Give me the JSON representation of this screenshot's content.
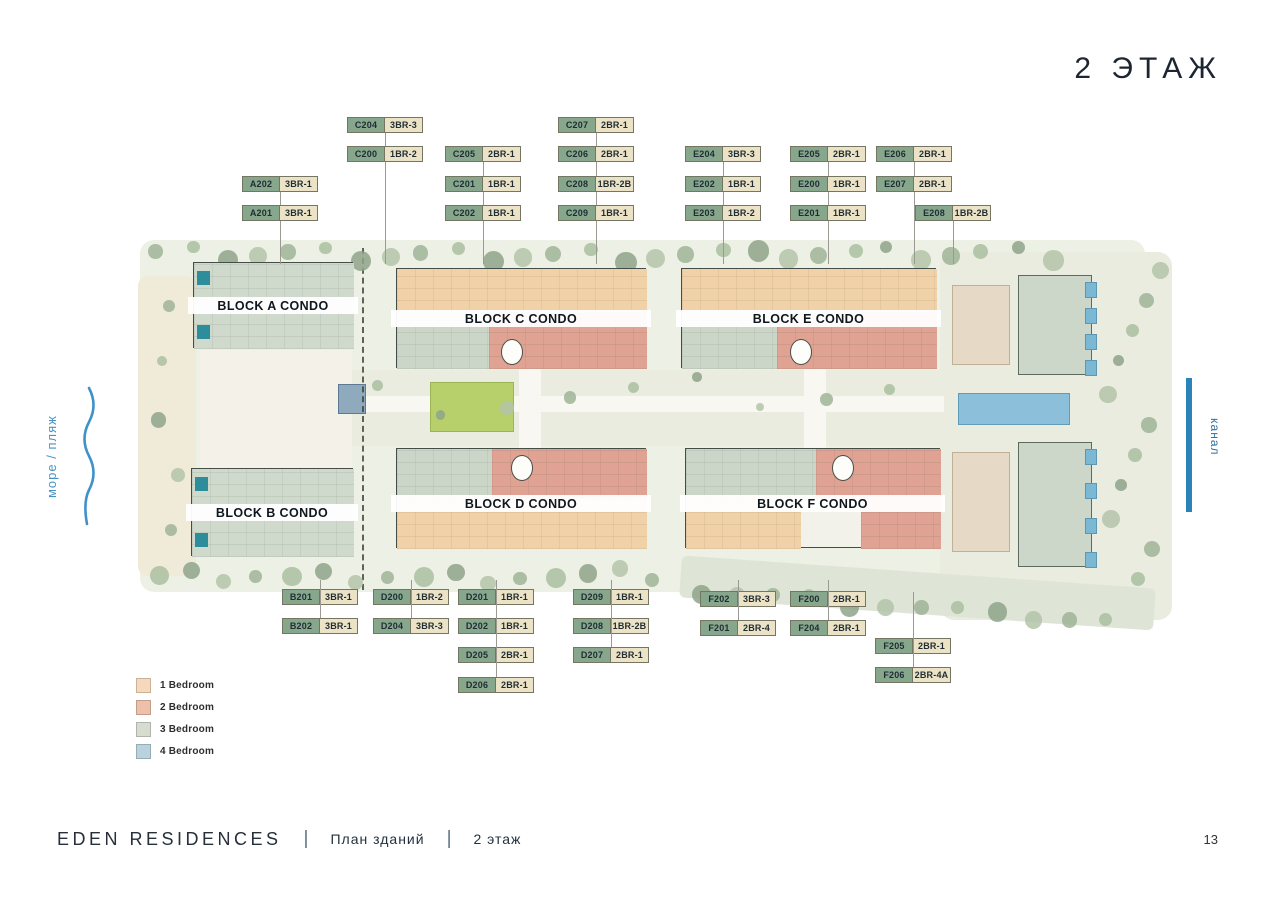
{
  "title": "2 ЭТАЖ",
  "page_number": "13",
  "side_labels": {
    "left": "море / пляж",
    "right": "канал"
  },
  "footer": {
    "brand": "EDEN RESIDENCES",
    "sep1": "|",
    "section": "План зданий",
    "sep2": "|",
    "floor": "2 этаж"
  },
  "legend": {
    "items": [
      {
        "label": "1 Bedroom",
        "color": "#f6d9ba"
      },
      {
        "label": "2 Bedroom",
        "color": "#eec0aa"
      },
      {
        "label": "3 Bedroom",
        "color": "#d6ddd0"
      },
      {
        "label": "4 Bedroom",
        "color": "#b9d2dd"
      }
    ]
  },
  "blocks": [
    {
      "id": "A",
      "label": "BLOCK A CONDO"
    },
    {
      "id": "B",
      "label": "BLOCK B CONDO"
    },
    {
      "id": "C",
      "label": "BLOCK C CONDO"
    },
    {
      "id": "D",
      "label": "BLOCK D CONDO"
    },
    {
      "id": "E",
      "label": "BLOCK E CONDO"
    },
    {
      "id": "F",
      "label": "BLOCK F CONDO"
    }
  ],
  "units": [
    {
      "unit": "A202",
      "type": "3BR-1",
      "x": 242,
      "y": 176,
      "dir": "down"
    },
    {
      "unit": "A201",
      "type": "3BR-1",
      "x": 242,
      "y": 205,
      "dir": "down"
    },
    {
      "unit": "C204",
      "type": "3BR-3",
      "x": 347,
      "y": 117,
      "dir": "down"
    },
    {
      "unit": "C200",
      "type": "1BR-2",
      "x": 347,
      "y": 146,
      "dir": "down"
    },
    {
      "unit": "C205",
      "type": "2BR-1",
      "x": 445,
      "y": 146,
      "dir": "down"
    },
    {
      "unit": "C201",
      "type": "1BR-1",
      "x": 445,
      "y": 176,
      "dir": "down"
    },
    {
      "unit": "C202",
      "type": "1BR-1",
      "x": 445,
      "y": 205,
      "dir": "down"
    },
    {
      "unit": "C207",
      "type": "2BR-1",
      "x": 558,
      "y": 117,
      "dir": "down"
    },
    {
      "unit": "C206",
      "type": "2BR-1",
      "x": 558,
      "y": 146,
      "dir": "down"
    },
    {
      "unit": "C208",
      "type": "1BR-2B",
      "x": 558,
      "y": 176,
      "dir": "down"
    },
    {
      "unit": "C209",
      "type": "1BR-1",
      "x": 558,
      "y": 205,
      "dir": "down"
    },
    {
      "unit": "E204",
      "type": "3BR-3",
      "x": 685,
      "y": 146,
      "dir": "down"
    },
    {
      "unit": "E202",
      "type": "1BR-1",
      "x": 685,
      "y": 176,
      "dir": "down"
    },
    {
      "unit": "E203",
      "type": "1BR-2",
      "x": 685,
      "y": 205,
      "dir": "down"
    },
    {
      "unit": "E205",
      "type": "2BR-1",
      "x": 790,
      "y": 146,
      "dir": "down"
    },
    {
      "unit": "E200",
      "type": "1BR-1",
      "x": 790,
      "y": 176,
      "dir": "down"
    },
    {
      "unit": "E201",
      "type": "1BR-1",
      "x": 790,
      "y": 205,
      "dir": "down"
    },
    {
      "unit": "E206",
      "type": "2BR-1",
      "x": 876,
      "y": 146,
      "dir": "down"
    },
    {
      "unit": "E207",
      "type": "2BR-1",
      "x": 876,
      "y": 176,
      "dir": "down"
    },
    {
      "unit": "E208",
      "type": "1BR-2B",
      "x": 915,
      "y": 205,
      "dir": "down"
    },
    {
      "unit": "B201",
      "type": "3BR-1",
      "x": 282,
      "y": 589,
      "dir": "up"
    },
    {
      "unit": "B202",
      "type": "3BR-1",
      "x": 282,
      "y": 618,
      "dir": "up"
    },
    {
      "unit": "D200",
      "type": "1BR-2",
      "x": 373,
      "y": 589,
      "dir": "up"
    },
    {
      "unit": "D204",
      "type": "3BR-3",
      "x": 373,
      "y": 618,
      "dir": "up"
    },
    {
      "unit": "D201",
      "type": "1BR-1",
      "x": 458,
      "y": 589,
      "dir": "up"
    },
    {
      "unit": "D202",
      "type": "1BR-1",
      "x": 458,
      "y": 618,
      "dir": "up"
    },
    {
      "unit": "D205",
      "type": "2BR-1",
      "x": 458,
      "y": 647,
      "dir": "up"
    },
    {
      "unit": "D206",
      "type": "2BR-1",
      "x": 458,
      "y": 677,
      "dir": "up"
    },
    {
      "unit": "D209",
      "type": "1BR-1",
      "x": 573,
      "y": 589,
      "dir": "up"
    },
    {
      "unit": "D208",
      "type": "1BR-2B",
      "x": 573,
      "y": 618,
      "dir": "up"
    },
    {
      "unit": "D207",
      "type": "2BR-1",
      "x": 573,
      "y": 647,
      "dir": "up"
    },
    {
      "unit": "F202",
      "type": "3BR-3",
      "x": 700,
      "y": 591,
      "dir": "up"
    },
    {
      "unit": "F201",
      "type": "2BR-4",
      "x": 700,
      "y": 620,
      "dir": "up"
    },
    {
      "unit": "F200",
      "type": "2BR-1",
      "x": 790,
      "y": 591,
      "dir": "up"
    },
    {
      "unit": "F204",
      "type": "2BR-1",
      "x": 790,
      "y": 620,
      "dir": "up"
    },
    {
      "unit": "F205",
      "type": "2BR-1",
      "x": 875,
      "y": 638,
      "dir": "up"
    },
    {
      "unit": "F206",
      "type": "2BR-4A",
      "x": 875,
      "y": 667,
      "dir": "up"
    }
  ]
}
